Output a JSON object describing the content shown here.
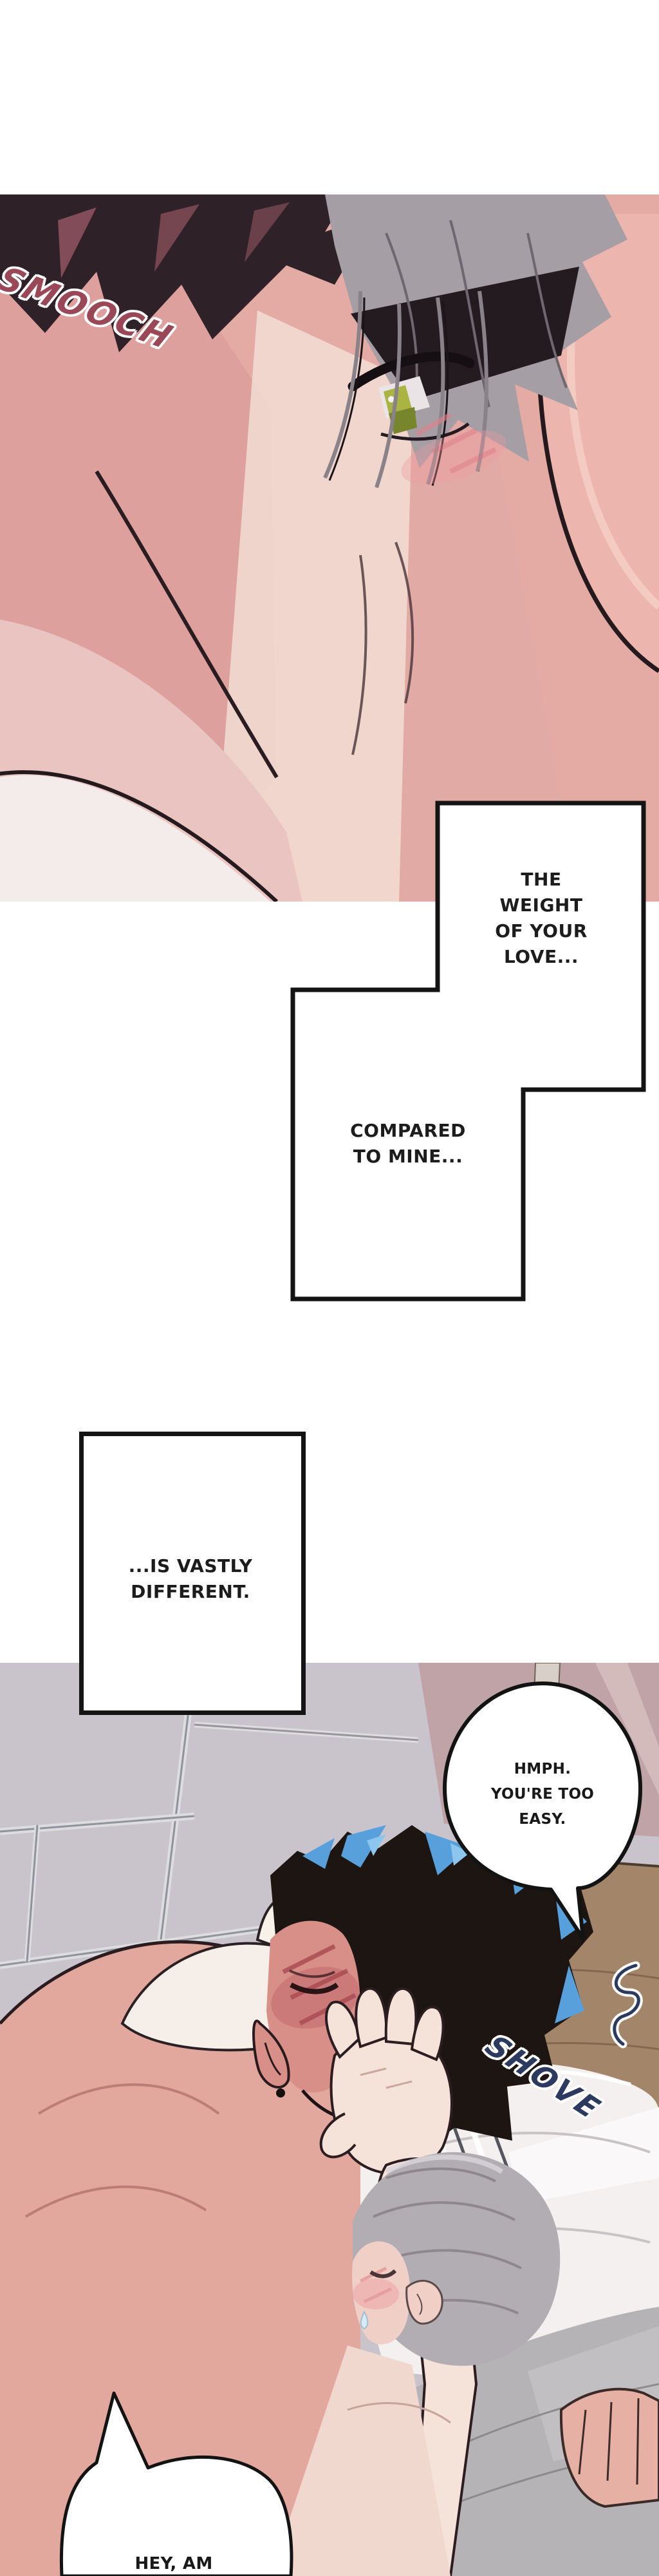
{
  "panel1": {
    "sfx": {
      "text": "SMOOCH",
      "color": "#9a4857"
    }
  },
  "captions": {
    "weight": {
      "lines": [
        "THE",
        "WEIGHT",
        "OF YOUR",
        "LOVE..."
      ]
    },
    "compared": {
      "lines": [
        "COMPARED",
        "TO MINE..."
      ]
    },
    "different": {
      "lines": [
        "...IS VASTLY",
        "DIFFERENT."
      ]
    }
  },
  "panel2": {
    "bubble_hmph": {
      "lines": [
        "HMPH.",
        "YOU'RE TOO",
        "EASY."
      ]
    },
    "sfx": {
      "text": "SHOVE",
      "color": "#2b3a5e"
    },
    "bubble_hey": {
      "lines": [
        "HEY, AM"
      ]
    }
  },
  "colors": {
    "sfx_smooch": "#9a4857",
    "sfx_shove": "#2b3a5e",
    "hair_blue_highlight": "#57a0dc",
    "eye_iris_green": "#a9b441",
    "caption_border": "#141414",
    "wall_left": "#c9c4cb",
    "wall_right_mauve": "#c0a3a7",
    "headboard_wood": "#a3866a",
    "skin_pink": "#e3aaa4"
  }
}
